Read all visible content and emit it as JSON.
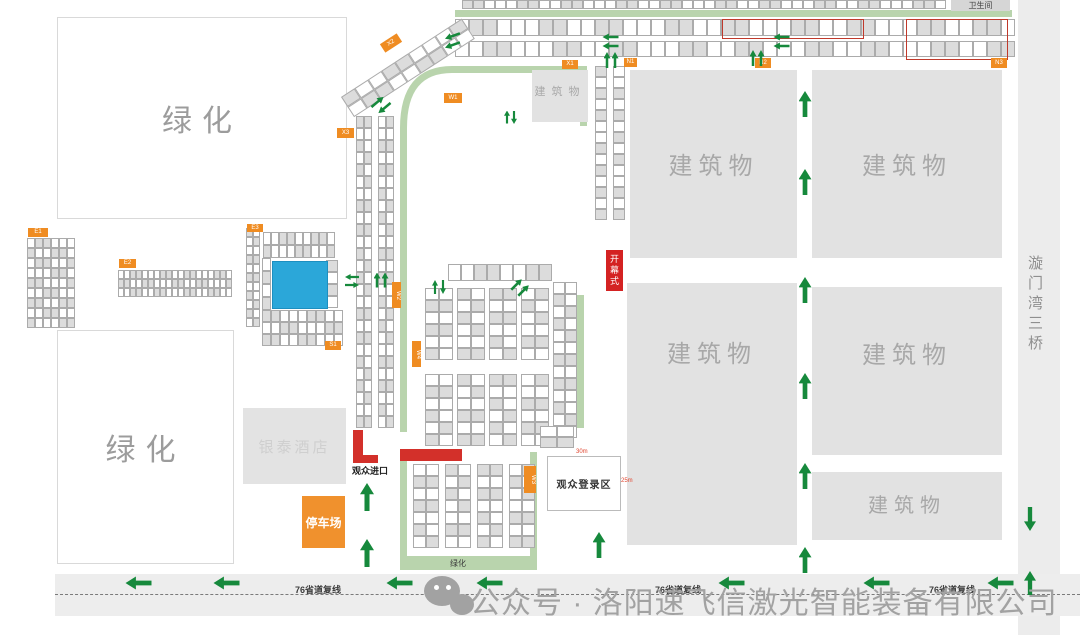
{
  "labels": {
    "greenery": "绿化",
    "building": "建筑物",
    "hotel": "银泰酒店",
    "parking": "停车场",
    "entrance": "观众进口",
    "registration": "观众登录区",
    "opening": "开幕式",
    "restroom": "卫生间",
    "bridge": "漩门湾三桥",
    "road": "76省道复线",
    "watermark": "公众号 · 洛阳速飞信激光智能装备有限公司",
    "dim_width": "30m",
    "dim_height": "25m"
  },
  "colors": {
    "zone_orange": "#ef8c22",
    "arrow_green": "#16893c",
    "road_green": "#b9d4ad",
    "marker_red": "#d3302a",
    "opening_red": "#d42222",
    "pool_blue": "#2ba7d9",
    "building_gray": "#e2e2e2",
    "booth_shaded": "#dcdcdc"
  },
  "zone_labels": [
    {
      "id": "X3",
      "text": "X3",
      "x": 337,
      "y": 128,
      "w": 17,
      "h": 10
    },
    {
      "id": "X2",
      "text": "X2",
      "x": 381,
      "y": 38,
      "w": 20,
      "h": 10,
      "rot": -33
    },
    {
      "id": "W1",
      "text": "W1",
      "x": 444,
      "y": 93,
      "w": 18,
      "h": 10
    },
    {
      "id": "E1",
      "text": "E1",
      "x": 28,
      "y": 228,
      "w": 20,
      "h": 9
    },
    {
      "id": "E2",
      "text": "E2",
      "x": 119,
      "y": 259,
      "w": 17,
      "h": 9
    },
    {
      "id": "E3",
      "text": "E3",
      "x": 247,
      "y": 224,
      "w": 16,
      "h": 8
    },
    {
      "id": "S1",
      "text": "S1",
      "x": 325,
      "y": 341,
      "w": 16,
      "h": 9
    },
    {
      "id": "X1",
      "text": "X1",
      "x": 562,
      "y": 60,
      "w": 16,
      "h": 9
    },
    {
      "id": "N1",
      "text": "N1",
      "x": 624,
      "y": 58,
      "w": 13,
      "h": 9
    },
    {
      "id": "N2",
      "text": "N2",
      "x": 755,
      "y": 58,
      "w": 16,
      "h": 10
    },
    {
      "id": "N3",
      "text": "N3",
      "x": 991,
      "y": 58,
      "w": 16,
      "h": 10
    },
    {
      "id": "W2",
      "text": "W2",
      "x": 392,
      "y": 282,
      "w": 9,
      "h": 26,
      "vert": true
    },
    {
      "id": "W4",
      "text": "W4",
      "x": 412,
      "y": 341,
      "w": 9,
      "h": 26,
      "vert": true
    },
    {
      "id": "W3",
      "text": "W3",
      "x": 524,
      "y": 466,
      "w": 12,
      "h": 27,
      "vert": true
    }
  ],
  "buildings": [
    {
      "x": 532,
      "y": 70,
      "w": 56,
      "h": 52,
      "fs": 11,
      "lt": 0.38
    },
    {
      "x": 630,
      "y": 70,
      "w": 167,
      "h": 188,
      "fs": 24,
      "lt": 0.48
    },
    {
      "x": 812,
      "y": 70,
      "w": 190,
      "h": 188,
      "fs": 24,
      "lt": 0.48
    },
    {
      "x": 627,
      "y": 283,
      "w": 170,
      "h": 262,
      "fs": 24,
      "lt": 0.25
    },
    {
      "x": 812,
      "y": 287,
      "w": 190,
      "h": 168,
      "fs": 24,
      "lt": 0.37
    },
    {
      "x": 812,
      "y": 472,
      "w": 190,
      "h": 68,
      "fs": 20,
      "lt": 0.42
    }
  ],
  "booth_clusters": [
    {
      "x": 462,
      "y": 0,
      "cols": 44,
      "rows": 1,
      "cw": 11,
      "ch": 9
    },
    {
      "x": 455,
      "y": 19,
      "cols": 40,
      "rows": 1,
      "cw": 14,
      "ch": 17
    },
    {
      "x": 455,
      "y": 41,
      "cols": 40,
      "rows": 1,
      "cw": 14,
      "ch": 16
    },
    {
      "x": 341,
      "y": 97,
      "cols": 9,
      "rows": 2,
      "cw": 16,
      "ch": 12,
      "rot": -33
    },
    {
      "x": 356,
      "y": 116,
      "cols": 2,
      "rows": 26,
      "cw": 8,
      "ch": 12
    },
    {
      "x": 378,
      "y": 116,
      "cols": 2,
      "rows": 26,
      "cw": 8,
      "ch": 12
    },
    {
      "x": 263,
      "y": 232,
      "cols": 9,
      "rows": 2,
      "cw": 8,
      "ch": 13
    },
    {
      "x": 262,
      "y": 258,
      "cols": 1,
      "rows": 6,
      "cw": 9,
      "ch": 13
    },
    {
      "x": 326,
      "y": 260,
      "cols": 1,
      "rows": 4,
      "cw": 12,
      "ch": 12
    },
    {
      "x": 262,
      "y": 310,
      "cols": 9,
      "rows": 3,
      "cw": 9,
      "ch": 12
    },
    {
      "x": 27,
      "y": 238,
      "cols": 6,
      "rows": 9,
      "cw": 8,
      "ch": 10
    },
    {
      "x": 118,
      "y": 270,
      "cols": 19,
      "rows": 3,
      "cw": 6,
      "ch": 9
    },
    {
      "x": 246,
      "y": 228,
      "cols": 2,
      "rows": 11,
      "cw": 7,
      "ch": 9
    },
    {
      "x": 595,
      "y": 66,
      "cols": 1,
      "rows": 14,
      "cw": 12,
      "ch": 11
    },
    {
      "x": 613,
      "y": 66,
      "cols": 1,
      "rows": 14,
      "cw": 12,
      "ch": 11
    },
    {
      "x": 448,
      "y": 264,
      "cols": 8,
      "rows": 1,
      "cw": 13,
      "ch": 17
    },
    {
      "x": 425,
      "y": 288,
      "cols": 2,
      "rows": 6,
      "cw": 14,
      "ch": 12
    },
    {
      "x": 457,
      "y": 288,
      "cols": 2,
      "rows": 6,
      "cw": 14,
      "ch": 12
    },
    {
      "x": 489,
      "y": 288,
      "cols": 2,
      "rows": 6,
      "cw": 14,
      "ch": 12
    },
    {
      "x": 521,
      "y": 288,
      "cols": 2,
      "rows": 6,
      "cw": 14,
      "ch": 12
    },
    {
      "x": 425,
      "y": 374,
      "cols": 2,
      "rows": 6,
      "cw": 14,
      "ch": 12
    },
    {
      "x": 457,
      "y": 374,
      "cols": 2,
      "rows": 6,
      "cw": 14,
      "ch": 12
    },
    {
      "x": 489,
      "y": 374,
      "cols": 2,
      "rows": 6,
      "cw": 14,
      "ch": 12
    },
    {
      "x": 521,
      "y": 374,
      "cols": 2,
      "rows": 6,
      "cw": 14,
      "ch": 12
    },
    {
      "x": 553,
      "y": 282,
      "cols": 2,
      "rows": 13,
      "cw": 12,
      "ch": 12
    },
    {
      "x": 413,
      "y": 464,
      "cols": 2,
      "rows": 7,
      "cw": 13,
      "ch": 12
    },
    {
      "x": 445,
      "y": 464,
      "cols": 2,
      "rows": 7,
      "cw": 13,
      "ch": 12
    },
    {
      "x": 477,
      "y": 464,
      "cols": 2,
      "rows": 7,
      "cw": 13,
      "ch": 12
    },
    {
      "x": 509,
      "y": 464,
      "cols": 2,
      "rows": 7,
      "cw": 13,
      "ch": 12
    },
    {
      "x": 540,
      "y": 426,
      "cols": 2,
      "rows": 2,
      "cw": 17,
      "ch": 11
    }
  ],
  "red_outlines": [
    {
      "x": 722,
      "y": 19,
      "w": 140,
      "h": 18
    },
    {
      "x": 906,
      "y": 19,
      "w": 100,
      "h": 39
    }
  ],
  "green_rects": [
    {
      "x": 455,
      "y": 10,
      "w": 557,
      "h": 7
    },
    {
      "x": 577,
      "y": 295,
      "w": 7,
      "h": 133
    }
  ],
  "arrows": [
    {
      "cx": 805,
      "cy": 104,
      "w": 13,
      "h": 26,
      "a": 0
    },
    {
      "cx": 805,
      "cy": 182,
      "w": 13,
      "h": 26,
      "a": 0
    },
    {
      "cx": 805,
      "cy": 290,
      "w": 13,
      "h": 26,
      "a": 0
    },
    {
      "cx": 805,
      "cy": 386,
      "w": 13,
      "h": 26,
      "a": 0
    },
    {
      "cx": 805,
      "cy": 476,
      "w": 13,
      "h": 26,
      "a": 0
    },
    {
      "cx": 805,
      "cy": 560,
      "w": 13,
      "h": 26,
      "a": 0
    },
    {
      "cx": 599,
      "cy": 545,
      "w": 13,
      "h": 26,
      "a": 0
    },
    {
      "cx": 367,
      "cy": 497,
      "w": 14,
      "h": 28,
      "a": 0
    },
    {
      "cx": 367,
      "cy": 553,
      "w": 14,
      "h": 28,
      "a": 0
    },
    {
      "cx": 1030,
      "cy": 519,
      "w": 12,
      "h": 24,
      "a": 180
    },
    {
      "cx": 1030,
      "cy": 583,
      "w": 12,
      "h": 24,
      "a": 0
    },
    {
      "cx": 138,
      "cy": 583,
      "w": 13,
      "h": 26,
      "a": 270
    },
    {
      "cx": 226,
      "cy": 583,
      "w": 13,
      "h": 26,
      "a": 270
    },
    {
      "cx": 399,
      "cy": 583,
      "w": 13,
      "h": 26,
      "a": 270
    },
    {
      "cx": 489,
      "cy": 583,
      "w": 13,
      "h": 26,
      "a": 270
    },
    {
      "cx": 731,
      "cy": 583,
      "w": 13,
      "h": 26,
      "a": 270
    },
    {
      "cx": 876,
      "cy": 583,
      "w": 13,
      "h": 26,
      "a": 270
    },
    {
      "cx": 1000,
      "cy": 583,
      "w": 13,
      "h": 26,
      "a": 270
    },
    {
      "cx": 781,
      "cy": 37,
      "w": 7,
      "h": 16,
      "a": 270
    },
    {
      "cx": 781,
      "cy": 46,
      "w": 7,
      "h": 16,
      "a": 270
    },
    {
      "cx": 610,
      "cy": 37,
      "w": 7,
      "h": 16,
      "a": 270
    },
    {
      "cx": 610,
      "cy": 46,
      "w": 7,
      "h": 16,
      "a": 270
    },
    {
      "cx": 452,
      "cy": 36,
      "w": 7,
      "h": 16,
      "a": 250
    },
    {
      "cx": 452,
      "cy": 45,
      "w": 7,
      "h": 16,
      "a": 250
    },
    {
      "cx": 753,
      "cy": 58,
      "w": 7,
      "h": 16,
      "a": 0
    },
    {
      "cx": 761,
      "cy": 58,
      "w": 7,
      "h": 16,
      "a": 0
    },
    {
      "cx": 607,
      "cy": 60,
      "w": 7,
      "h": 16,
      "a": 0
    },
    {
      "cx": 615,
      "cy": 60,
      "w": 7,
      "h": 16,
      "a": 0
    },
    {
      "cx": 377,
      "cy": 280,
      "w": 7,
      "h": 15,
      "a": 0
    },
    {
      "cx": 385,
      "cy": 280,
      "w": 7,
      "h": 15,
      "a": 0
    },
    {
      "cx": 377,
      "cy": 102,
      "w": 7,
      "h": 16,
      "a": 50
    },
    {
      "cx": 384,
      "cy": 108,
      "w": 7,
      "h": 16,
      "a": 230
    },
    {
      "cx": 516,
      "cy": 284,
      "w": 7,
      "h": 15,
      "a": 45
    },
    {
      "cx": 523,
      "cy": 290,
      "w": 7,
      "h": 15,
      "a": 45
    },
    {
      "cx": 352,
      "cy": 277,
      "w": 6,
      "h": 14,
      "a": 270
    },
    {
      "cx": 352,
      "cy": 285,
      "w": 6,
      "h": 14,
      "a": 90
    },
    {
      "cx": 435,
      "cy": 287,
      "w": 6,
      "h": 14,
      "a": 0
    },
    {
      "cx": 443,
      "cy": 287,
      "w": 6,
      "h": 14,
      "a": 180
    },
    {
      "cx": 507,
      "cy": 117,
      "w": 6,
      "h": 13,
      "a": 0
    },
    {
      "cx": 514,
      "cy": 117,
      "w": 6,
      "h": 13,
      "a": 180
    }
  ],
  "road_label_positions": [
    318,
    678,
    952
  ]
}
